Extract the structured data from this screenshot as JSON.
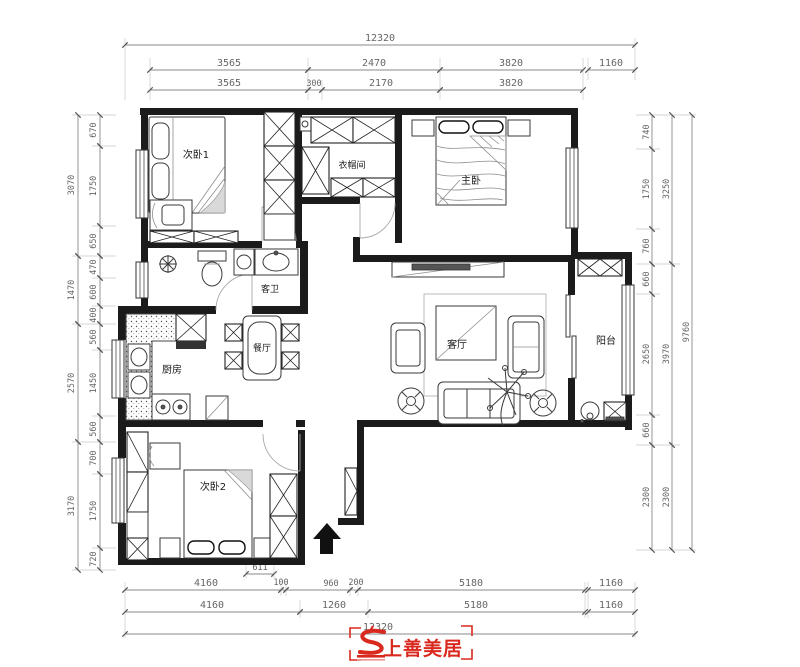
{
  "page": {
    "background": "#ffffff"
  },
  "colors": {
    "wall": "#1b1b1b",
    "furniture_line": "#3a3a3a",
    "dim_line": "#8a8a8a",
    "dim_text": "#666666",
    "logo_red": "#d9281e"
  },
  "floor_plan": {
    "rooms": {
      "bedroom1": {
        "label": "次卧1"
      },
      "cloakroom": {
        "label": "衣帽间"
      },
      "master_bedroom": {
        "label": "主卧"
      },
      "guest_bathroom": {
        "label": "客卫"
      },
      "dining_room": {
        "label": "餐厅"
      },
      "kitchen": {
        "label": "厨房"
      },
      "living_room": {
        "label": "客厅"
      },
      "balcony": {
        "label": "阳台"
      },
      "bedroom2": {
        "label": "次卧2"
      }
    }
  },
  "dimensions": {
    "top": {
      "total": "12320",
      "row2": [
        "3565",
        "2470",
        "3820",
        "1160"
      ],
      "row3": [
        "3565",
        "300",
        "2170",
        "3820"
      ]
    },
    "bottom": {
      "inner": "611",
      "row1": [
        "4160",
        "100",
        "960",
        "200",
        "5180",
        "1160"
      ],
      "row2": [
        "4160",
        "1260",
        "5180",
        "1160"
      ],
      "total": "12320"
    },
    "left": {
      "outer": [
        "3070",
        "1470",
        "2570",
        "3170"
      ],
      "inner": [
        "670",
        "1750",
        "650",
        "470",
        "600",
        "400",
        "560",
        "1450",
        "560",
        "700",
        "1750",
        "720"
      ]
    },
    "right": {
      "inner": [
        "740",
        "1750",
        "760",
        "660",
        "2650",
        "660",
        "2300"
      ],
      "mid": [
        "3250",
        "3970",
        "2300"
      ],
      "total": "9760"
    }
  },
  "logo": {
    "brand": "上善美居"
  }
}
